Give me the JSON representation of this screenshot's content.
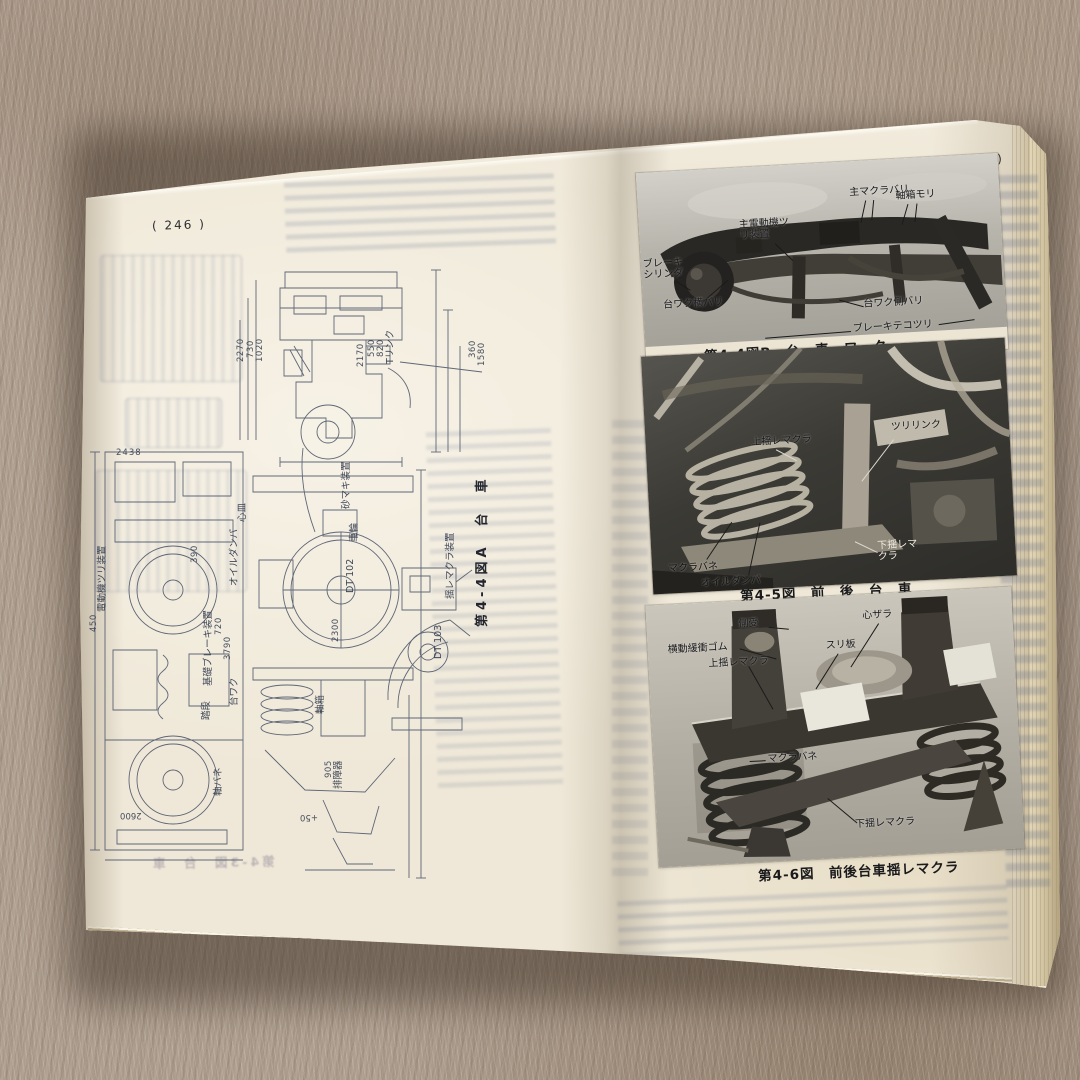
{
  "book": {
    "left_page": {
      "page_number": "( 246 )",
      "figure_caption": "第4-4図A　台　車",
      "ghost_caption": "第4-3図　台　車",
      "labels": {
        "t_link": "Tリンク",
        "yure_makura_souchi": "揺レマクラ装置",
        "dendouki_tsuri": "電動機ツリ装置",
        "sunamaki": "砂マキ装置",
        "sharin": "車輪",
        "jikubako": "軸箱",
        "daiwaku": "台ワク",
        "kiso_brake": "基礎ブレーキ装置",
        "jikubane": "軸バネ",
        "oil_damper": "オイルダンパ",
        "haishouki": "排障器",
        "fumidan": "踏段",
        "shinzara": "心皿",
        "dt102": "DT 102",
        "dt103": "DT 103"
      },
      "dimensions": {
        "d2270": "2270",
        "d730": "730",
        "d1020": "1020",
        "d2170": "2170",
        "d550": "550",
        "d820": "820",
        "d360": "360",
        "d1580": "1580",
        "d2438": "2438",
        "d450": "450",
        "d390": "390",
        "d720": "720",
        "d3790": "3790",
        "d2300": "2300",
        "d905": "905",
        "d2600": "2600",
        "d50": "+50"
      }
    },
    "right_page": {
      "page_number": "( 247 )",
      "figures": [
        {
          "caption": "第4-4図B　台　車　ワ　ク",
          "labels": [
            "主電動機ツリ装置",
            "主マクラバリ",
            "軸箱モリ",
            "ブレーキシリンダ",
            "台ワク横バリ",
            "台ワク側バリ",
            "ブレーキテコツリ"
          ]
        },
        {
          "caption": "第4-5図　前　後　台　車",
          "labels": [
            "上揺レマクラ",
            "ツリリンク",
            "マクラバネ",
            "オイルダンパ",
            "下揺レマクラ"
          ]
        },
        {
          "caption": "第4-6図　前後台車揺レマクラ",
          "labels": [
            "側受",
            "横動緩衝ゴム",
            "上揺レマクラ",
            "心ザラ",
            "スリ板",
            "マクラバネ",
            "下揺レマクラ"
          ]
        }
      ]
    }
  },
  "colors": {
    "page": "#efe8d8",
    "carpet": "#b3a496",
    "print_line": "#46506a",
    "photo_dark": "#2a2824"
  }
}
